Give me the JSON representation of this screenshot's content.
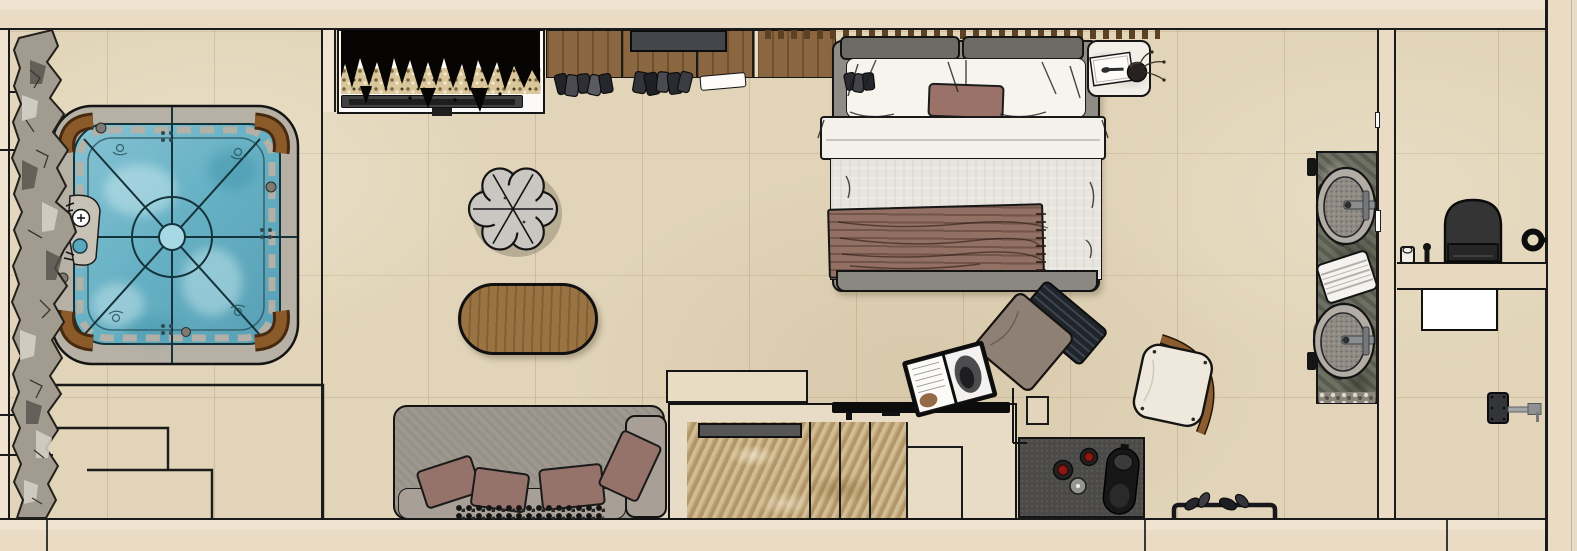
{
  "scene": {
    "name": "hotel-suite-top-view-floor-plan",
    "render_style": "sketch 3d top-down render",
    "canvas": {
      "width": 1577,
      "height": 551
    }
  },
  "palette": {
    "ink": "#161616",
    "wallLine": "#1b1b1b",
    "floor": "#e1d4b8",
    "wall": "#eadbc5",
    "wallLight": "#f0e3d0",
    "rock": "#a29c90",
    "tubRim": "#b6b0a5",
    "water": "#6fb5c8",
    "tubWood": "#8a5a28",
    "plant": "#060503",
    "gravel": "#d9c79b",
    "shelf": "#414141",
    "wood": "#8a6740",
    "tv": "#43464a",
    "slat": "#5c4223",
    "bedFrame": "#8f8c85",
    "headboard": "#6e6b64",
    "bedWhite": "#f7f4ee",
    "sheet": "#f4f1ea",
    "duvet": "#e8e5de",
    "mauve": "#9a7268",
    "throwColor": "#927063",
    "nightstand": "#f2eee8",
    "pouf": "#cac7c2",
    "tableWood": "#9a7343",
    "sofa": "#9f988f",
    "sofaSeat": "#a8a096",
    "pillow": "#96736a",
    "blanket": "#101010",
    "counter": "#e9dcc6",
    "marble": "#c0a678",
    "tray": "#565656",
    "rail": "#0c0c0c",
    "island": "#4b4a48",
    "burner": "#8f1712",
    "chrome": "#a3a5a7",
    "chairSeat": "#8e8074",
    "stool": "#eee9dc",
    "stoolWood": "#8a5c30",
    "vanity": "#6f7064",
    "sinkRim": "#b2ada4",
    "towel": "#f5f3ef",
    "toilet": "#343434",
    "matWhite": "#ffffff"
  },
  "areas": {
    "spa_patio": {
      "items": [
        "rock-border",
        "hot-tub",
        "tub-corner-seats",
        "tub-control-pad",
        "terrace-steps"
      ],
      "tub_corner_seats": 4
    },
    "living": {
      "items": [
        "planter-media-shelf",
        "wardrobe",
        "hanging-clothes",
        "flower-pouf",
        "oval-coffee-table",
        "sofa",
        "sofa-pillows",
        "knit-blanket"
      ],
      "sofa_pillows": 4,
      "wardrobe_sections": 4
    },
    "bedroom": {
      "items": [
        "slat-headboard-wall",
        "double-bed",
        "head-cushions",
        "white-pillows",
        "accent-cushion",
        "folded-sheet",
        "duvet",
        "fringed-throw",
        "nightstand",
        "desk-chair",
        "open-magazine",
        "stool",
        "slipper-rack"
      ],
      "slippers": 4
    },
    "kitchenette": {
      "items": [
        "upper-cabinet",
        "travertine-counter",
        "inset-tray",
        "black-rail",
        "cooktop-island",
        "burners",
        "control-knob",
        "kettle"
      ],
      "burners": 2
    },
    "bathroom": {
      "items": [
        "double-vanity",
        "vessel-sinks",
        "faucets",
        "towel-stack",
        "wall-hooks",
        "pebble-strip",
        "toilet",
        "shelf-ledge",
        "canister",
        "toilet-brush",
        "door-knob",
        "bath-mat",
        "shower-arm"
      ],
      "sinks": 2
    }
  }
}
